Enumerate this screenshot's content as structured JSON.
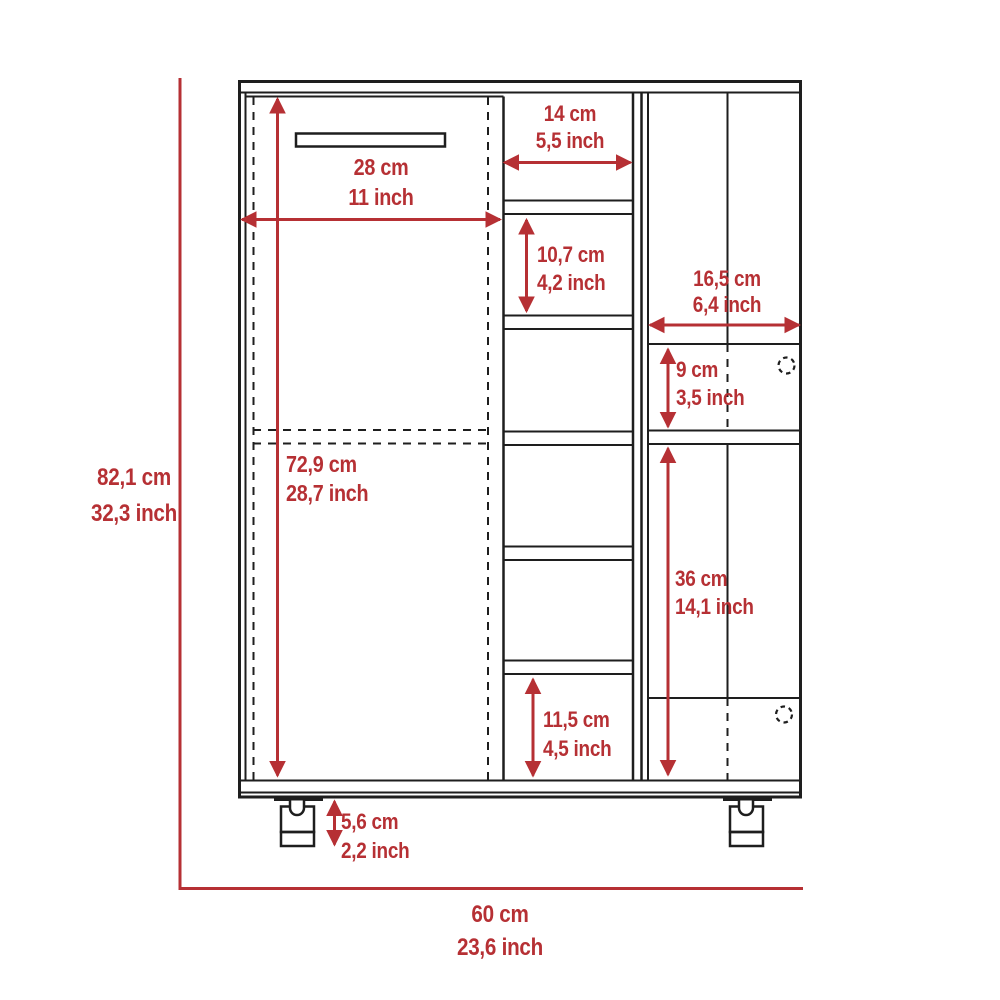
{
  "palette": {
    "accent_red": "#b63034",
    "line_black": "#1e1e1e",
    "background": "#ffffff"
  },
  "drawing": {
    "subject": "bar cart cabinet front-view technical drawing with dimensions"
  },
  "dimensions": {
    "overall_height": {
      "cm": "82,1 cm",
      "inch": "32,3 inch"
    },
    "overall_width": {
      "cm": "60 cm",
      "inch": "23,6 inch"
    },
    "door_width": {
      "cm": "28 cm",
      "inch": "11 inch"
    },
    "door_height": {
      "cm": "72,9 cm",
      "inch": "28,7 inch"
    },
    "cubby_width": {
      "cm": "14 cm",
      "inch": "5,5 inch"
    },
    "cubby_height": {
      "cm": "10,7 cm",
      "inch": "4,2 inch"
    },
    "right_section_width": {
      "cm": "16,5 cm",
      "inch": "6,4 inch"
    },
    "drawer_height": {
      "cm": "9 cm",
      "inch": "3,5 inch"
    },
    "lower_cabinet_height": {
      "cm": "36 cm",
      "inch": "14,1 inch"
    },
    "bottom_cubby_height": {
      "cm": "11,5 cm",
      "inch": "4,5 inch"
    },
    "caster_height": {
      "cm": "5,6 cm",
      "inch": "2,2 inch"
    }
  }
}
